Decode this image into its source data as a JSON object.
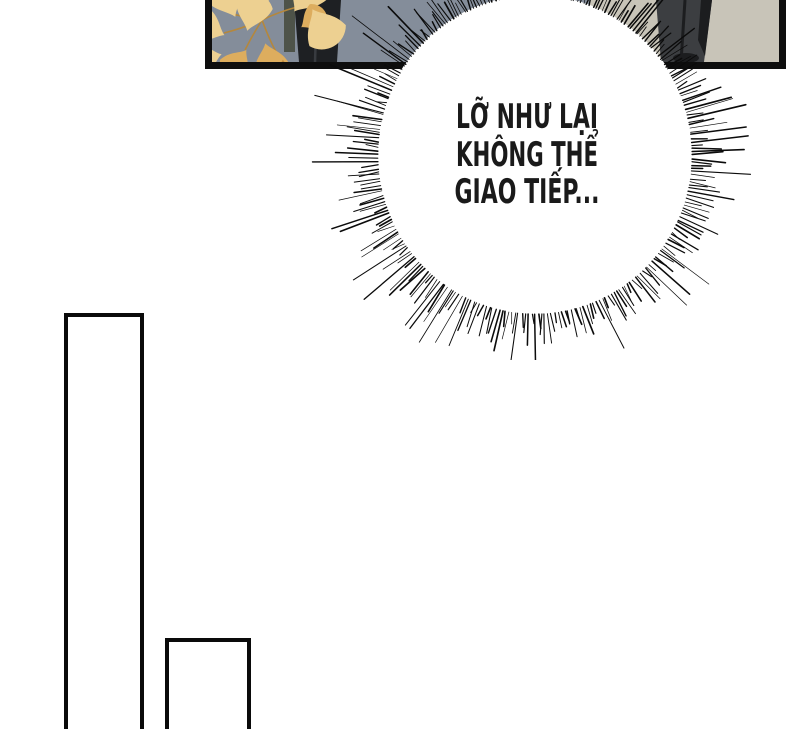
{
  "page_type": "comic-page",
  "bubble": {
    "lines": [
      "LỠ NHƯ LẠI",
      "KHÔNG THỂ",
      "GIAO TIẾP..."
    ]
  },
  "colors": {
    "page_bg": "#ffffff",
    "panel_border": "#0e0e0e",
    "wall_left": "#848d9a",
    "wall_right": "#c8c4b8",
    "leaf_light": "#edd091",
    "leaf_mid": "#ddad5e",
    "leaf_deep": "#c08a3f",
    "leaf_stem": "#b5873b",
    "suit_left_dark": "#1e2023",
    "suit_left_highlight": "#383b40",
    "coat_olive": "#4e5349",
    "suit_right": "#3c3e41",
    "suit_right_dark": "#1c1d1f",
    "bubble_fill": "#ffffff",
    "flash_stroke": "#0b0b0b",
    "text": "#1a1a1a",
    "next_panel_border": "#0a0a0a"
  }
}
